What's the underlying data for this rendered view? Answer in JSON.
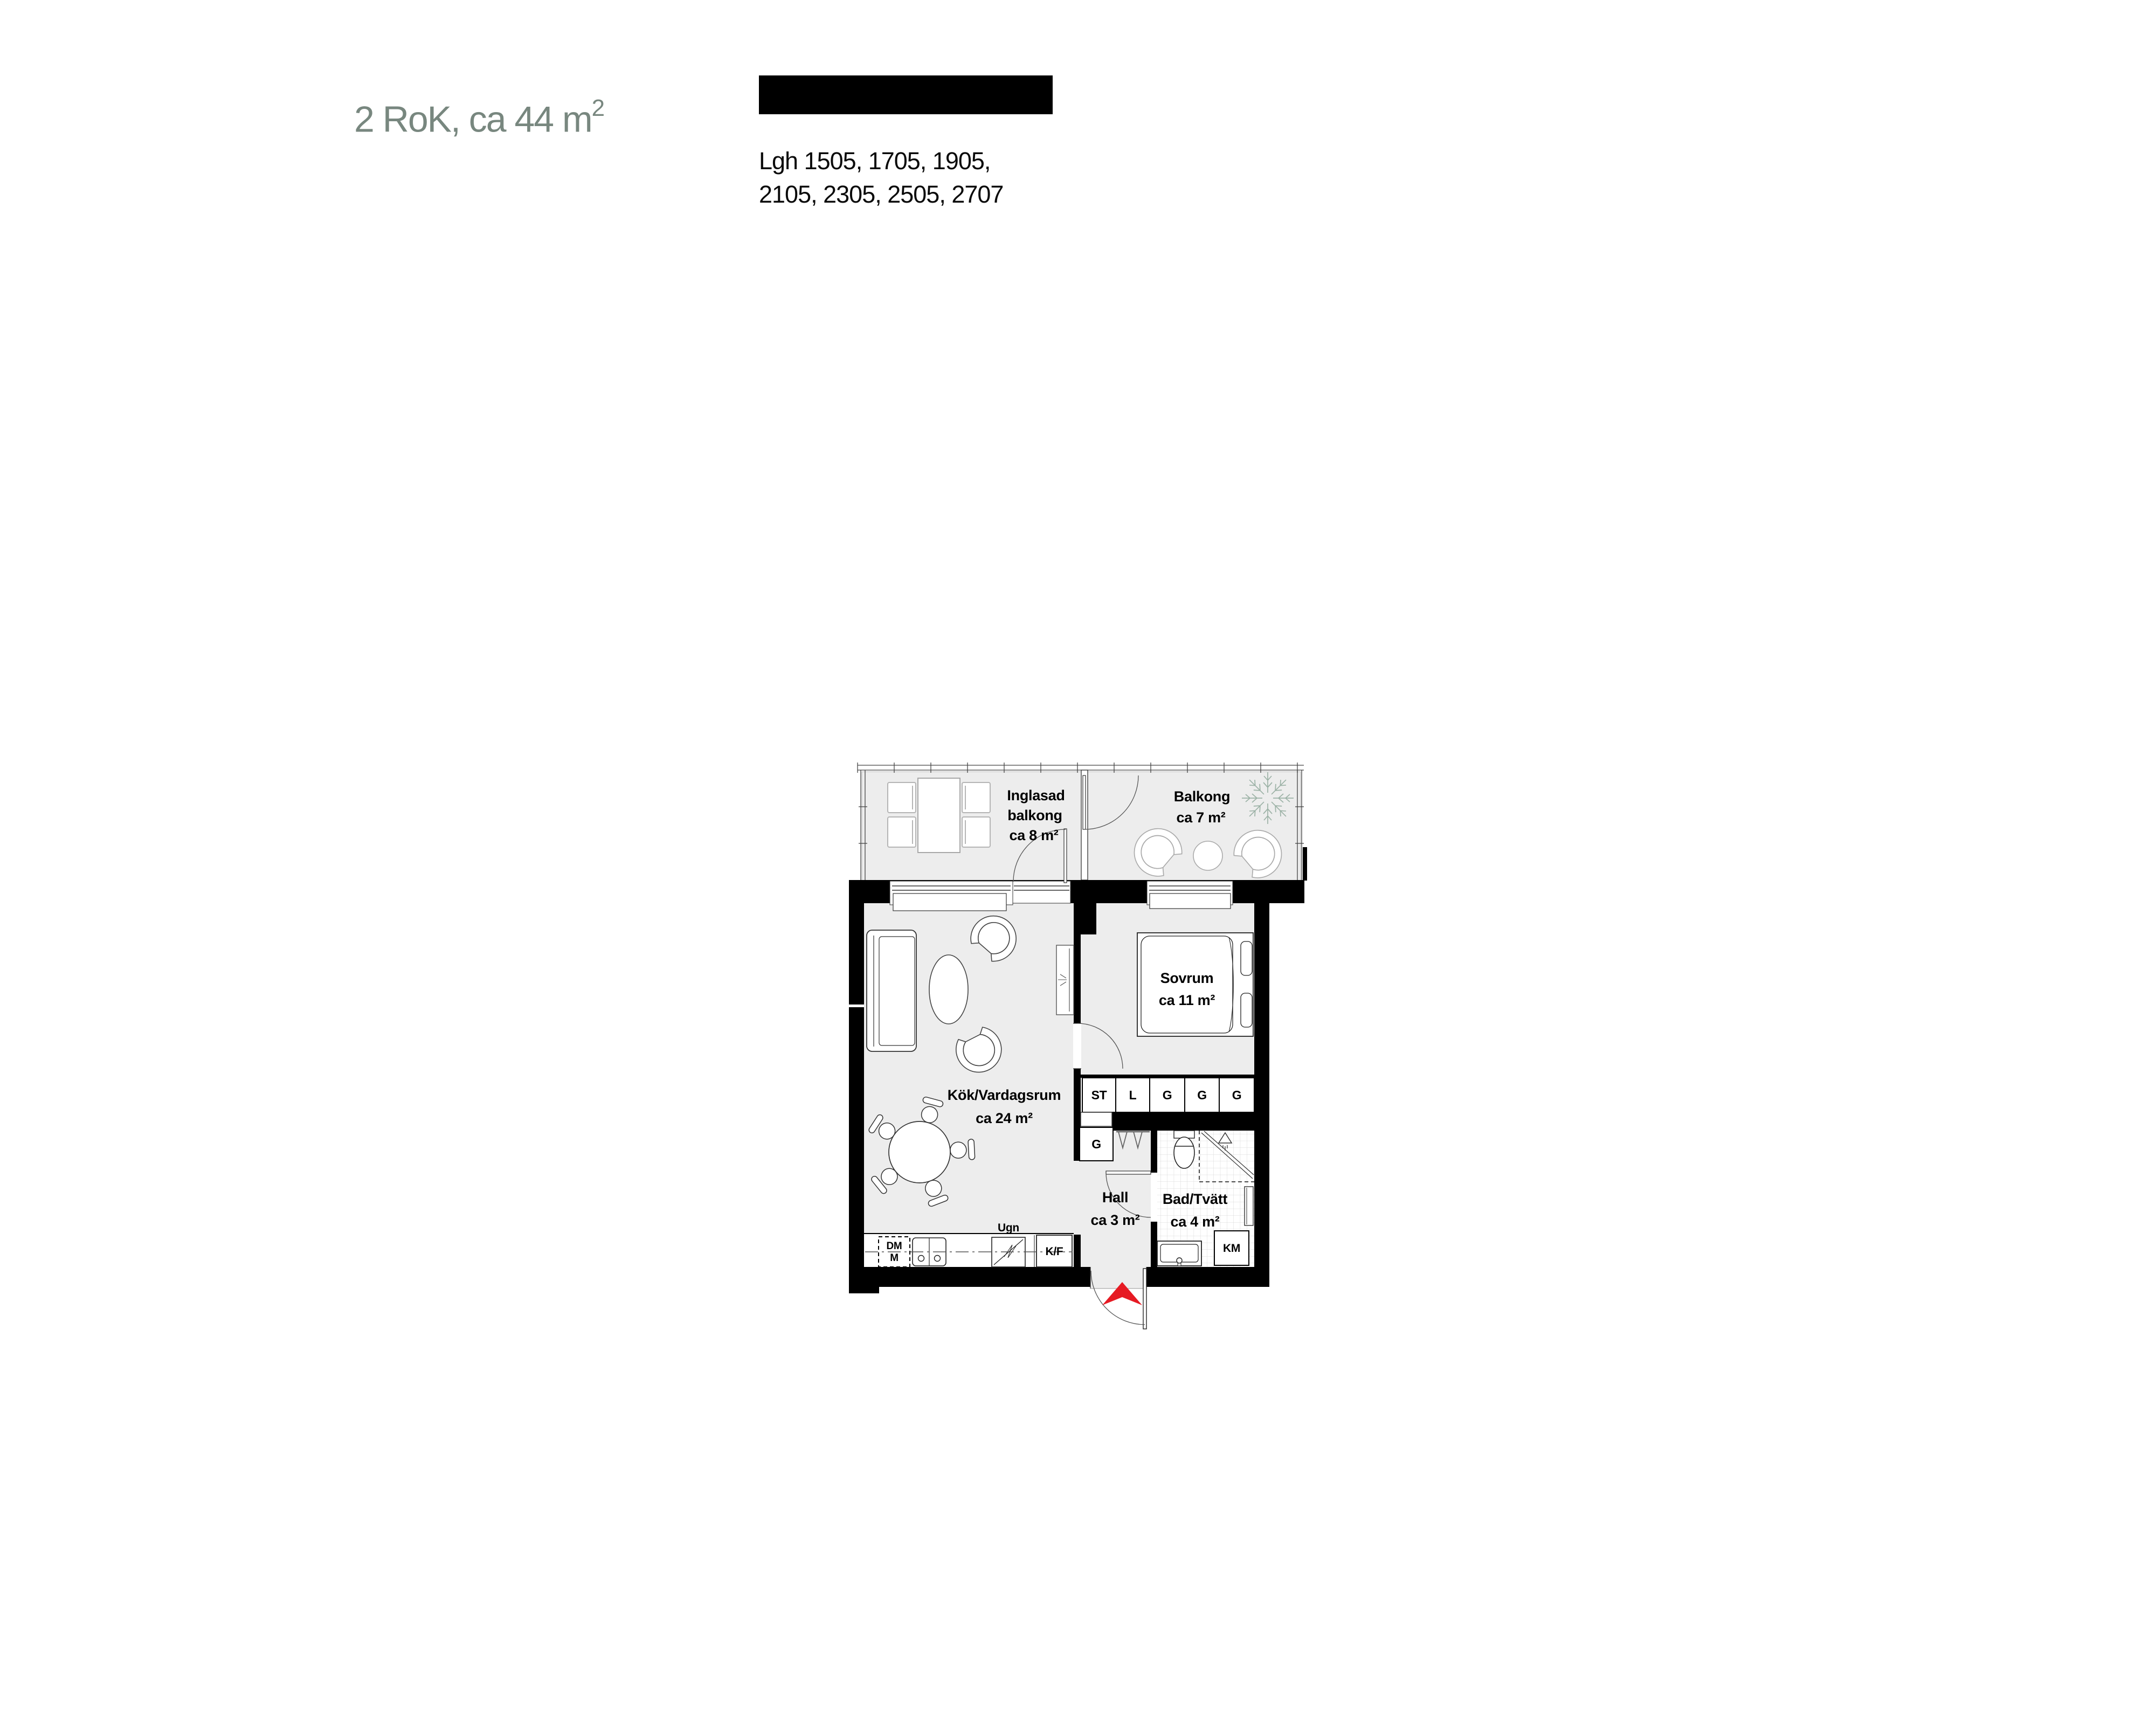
{
  "page": {
    "title": {
      "main": "2 RoK, ca 44 m",
      "sup": "2"
    },
    "apartments": {
      "line1": "Lgh 1505, 1705, 1905,",
      "line2": "2105, 2305, 2505, 2707"
    }
  },
  "plan": {
    "rooms": {
      "inglasad": {
        "l1": "Inglasad",
        "l2": "balkong",
        "l3": "ca 8 m²"
      },
      "balkong": {
        "l1": "Balkong",
        "l2": "ca 7 m²"
      },
      "kok": {
        "l1": "Kök/Vardagsrum",
        "l2": "ca 24 m²"
      },
      "sovrum": {
        "l1": "Sovrum",
        "l2": "ca 11 m²"
      },
      "hall": {
        "l1": "Hall",
        "l2": "ca 3 m²"
      },
      "bad": {
        "l1": "Bad/Tvätt",
        "l2": "ca 4 m²"
      }
    },
    "closets": {
      "w1": "ST",
      "w2": "L",
      "w3": "G",
      "w4": "G",
      "w5": "G",
      "hall_g": "G"
    },
    "appliances": {
      "dm": "DM",
      "m": "M",
      "ugn": "Ugn",
      "kf": "K/F",
      "km": "KM"
    },
    "icons": {
      "entrance_arrow": "red-triangle-up",
      "plant": "fern-star",
      "shower_head": "triangle-spray"
    },
    "colors": {
      "floor": "#ededed",
      "wall": "#000000",
      "accent_red": "#e61a23",
      "plant_green": "#9cb2a6",
      "title_green": "#78877f"
    }
  }
}
